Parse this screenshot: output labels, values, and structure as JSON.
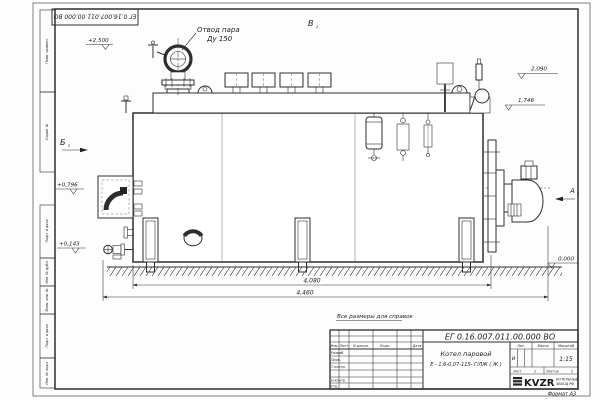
{
  "stamp": {
    "number": "ЕГ 0.16.007.011.00.000  ВО"
  },
  "annotations": {
    "steam1": "Отвод пара",
    "steam2": "Ду 150",
    "el_2500": "+2,500",
    "el_2090": "2,090",
    "el_1746": "1,746",
    "el_0796": "+0,796",
    "el_0143": "+0,143",
    "el_0000": "0,000",
    "dim_4080": "4,080",
    "dim_4460": "4,460",
    "view_b": "Б",
    "view_v": "В",
    "view_a": "А",
    "view_sheet_ref": "2",
    "note": "Все размеры для справок"
  },
  "side_column": {
    "items": [
      "Перв. примен.",
      "Справ. №",
      "Подп. и дата",
      "Инв. № дубл.",
      "Взам. инв. №",
      "Подп. и дата",
      "Инв. № подл."
    ]
  },
  "title_block": {
    "doc_number": "ЕГ 0.16.007.011.00.000  ВО",
    "name_line1": "Котел паровой",
    "name_line2": "Е - 1,6-0,07-115- Г/ЛЖ ( Ж )",
    "col_izm": "Изм.",
    "col_list": "Лист",
    "col_doc": "N докум.",
    "col_podp": "Подп.",
    "col_data": "Дата",
    "row_razrab": "Разраб.",
    "row_prov": "Пров.",
    "row_tkontr": "Т.контр.",
    "row_nkontr": "Н.контр.",
    "row_utv": "Утв.",
    "lit": "Лит.",
    "massa": "Масса",
    "scale_label": "Масштаб",
    "lit_value": "И",
    "scale": "1:15",
    "sheet_label": "Лист",
    "sheet_number": "1",
    "sheets_label": "Листов",
    "sheets_total": "2",
    "logo": "KVZR",
    "logo_sub1": "КОТЕЛЬНЫЙ",
    "logo_sub2": "ЗАВОД РФ",
    "format": "Формат А3"
  }
}
